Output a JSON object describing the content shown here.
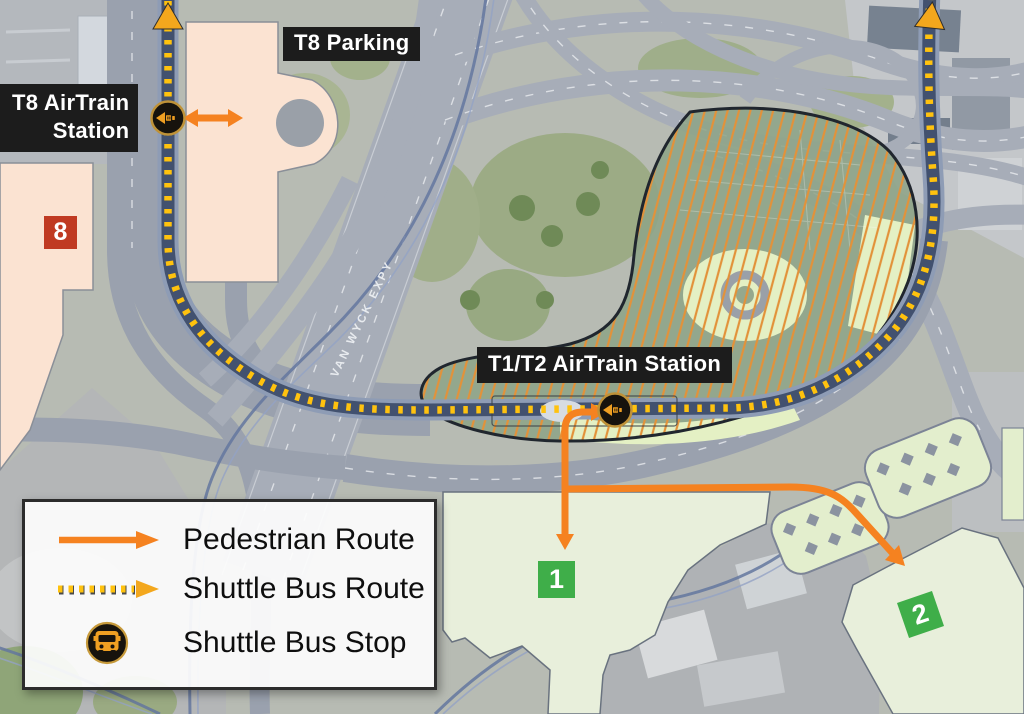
{
  "map": {
    "station_labels": {
      "t8_airtrain": {
        "line1": "T8 AirTrain",
        "line2": "Station"
      },
      "t8_parking": "T8 Parking",
      "t1t2_airtrain": "T1/T2 AirTrain Station"
    },
    "road_label": "VAN WYCK EXPY",
    "terminal_badges": {
      "t8": {
        "label": "8",
        "color": "#c03a22"
      },
      "t1": {
        "label": "1",
        "color": "#3fae49"
      },
      "t2": {
        "label": "2",
        "color": "#3fae49"
      }
    },
    "shuttle_bus_stops": [
      {
        "location": "T8 AirTrain Station"
      },
      {
        "location": "T1/T2 AirTrain Station"
      }
    ]
  },
  "legend": {
    "items": [
      {
        "id": "pedestrian-route",
        "label": "Pedestrian Route"
      },
      {
        "id": "shuttle-bus-route",
        "label": "Shuttle Bus Route"
      },
      {
        "id": "shuttle-bus-stop",
        "label": "Shuttle Bus Stop"
      }
    ]
  },
  "colors": {
    "pedestrian_route": "#f58220",
    "shuttle_dash": "#ffc20e",
    "guideway_band": "#42516f",
    "construction_hatch": "#e2923a",
    "construction_fill": "#8ea487",
    "label_background": "#1c1c1c",
    "terminal_fill": "#e8efdb",
    "t8_building_fill": "#fbe3d2",
    "badge_red": "#c03a22",
    "badge_green": "#3fae49"
  }
}
